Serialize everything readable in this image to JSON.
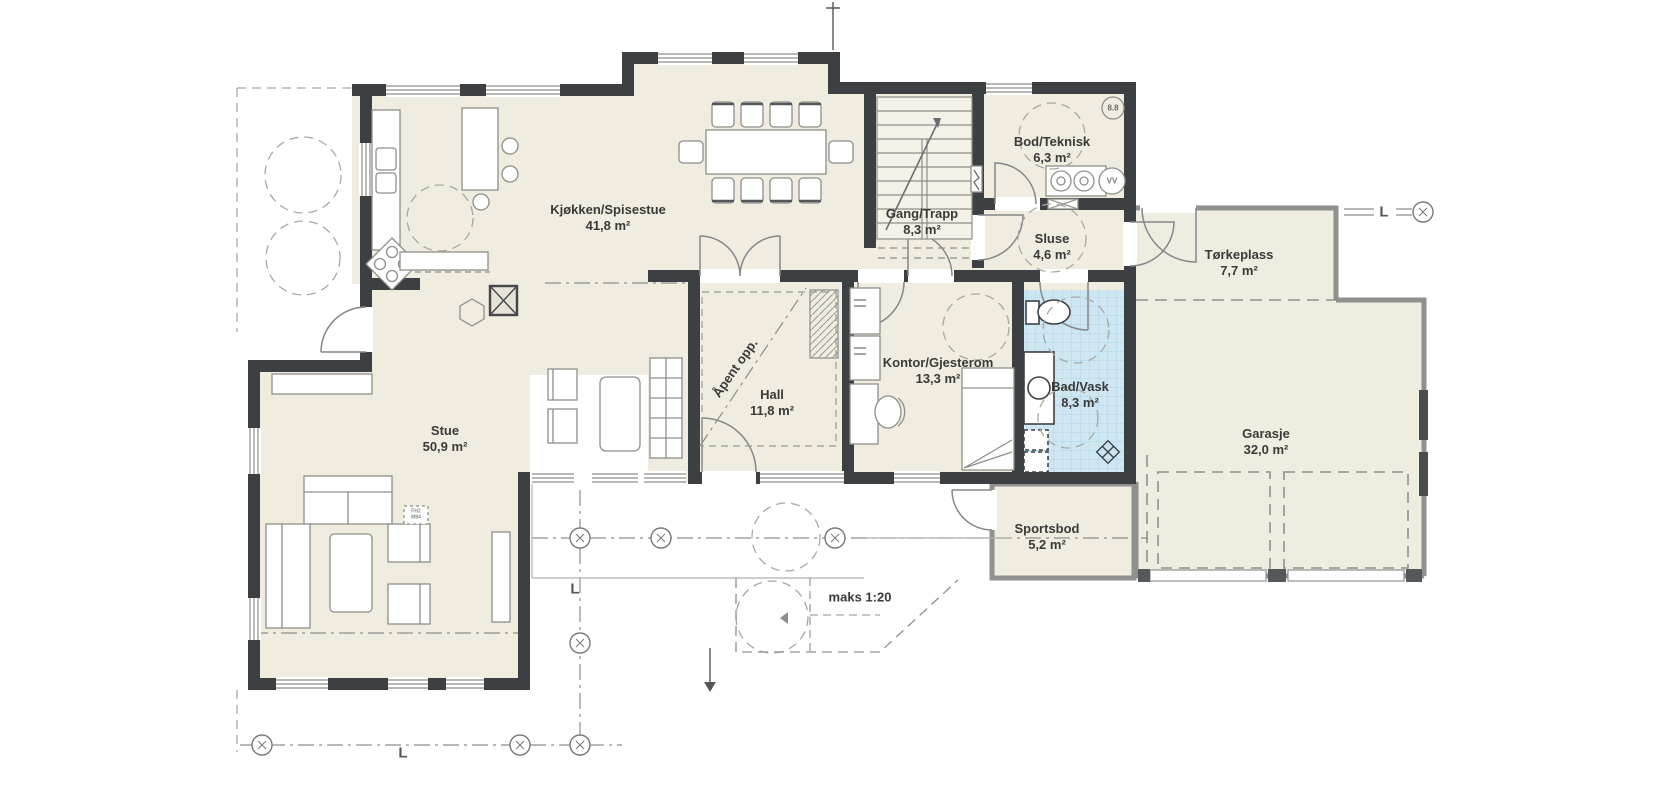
{
  "plan": {
    "rooms": [
      {
        "name": "Kjøkken/Spisestue",
        "area": "41,8 m²"
      },
      {
        "name": "Gang/Trapp",
        "area": "8,3 m²"
      },
      {
        "name": "Bod/Teknisk",
        "area": "6,3 m²"
      },
      {
        "name": "Sluse",
        "area": "4,6 m²"
      },
      {
        "name": "Tørkeplass",
        "area": "7,7 m²"
      },
      {
        "name": "Hall",
        "area": "11,8 m²"
      },
      {
        "name": "Kontor/Gjesterom",
        "area": "13,3 m²"
      },
      {
        "name": "Bad/Vask",
        "area": "8,3 m²"
      },
      {
        "name": "Stue",
        "area": "50,9 m²"
      },
      {
        "name": "Garasje",
        "area": "32,0 m²"
      },
      {
        "name": "Sportsbod",
        "area": "5,2 m²"
      }
    ],
    "annotations": {
      "open_above": "Åpent opp.",
      "ramp_slope": "maks 1:20",
      "grid_letter": "L",
      "ref_badge": "8.8",
      "water_heater": "VV",
      "furniture_tag": [
        "FH2",
        "M84"
      ]
    },
    "colors": {
      "wall": "#3d4043",
      "floor": "#f0ecdf",
      "bath_tile": "#cfe7f2",
      "line": "#8e8e8a",
      "background": "#ffffff"
    }
  }
}
